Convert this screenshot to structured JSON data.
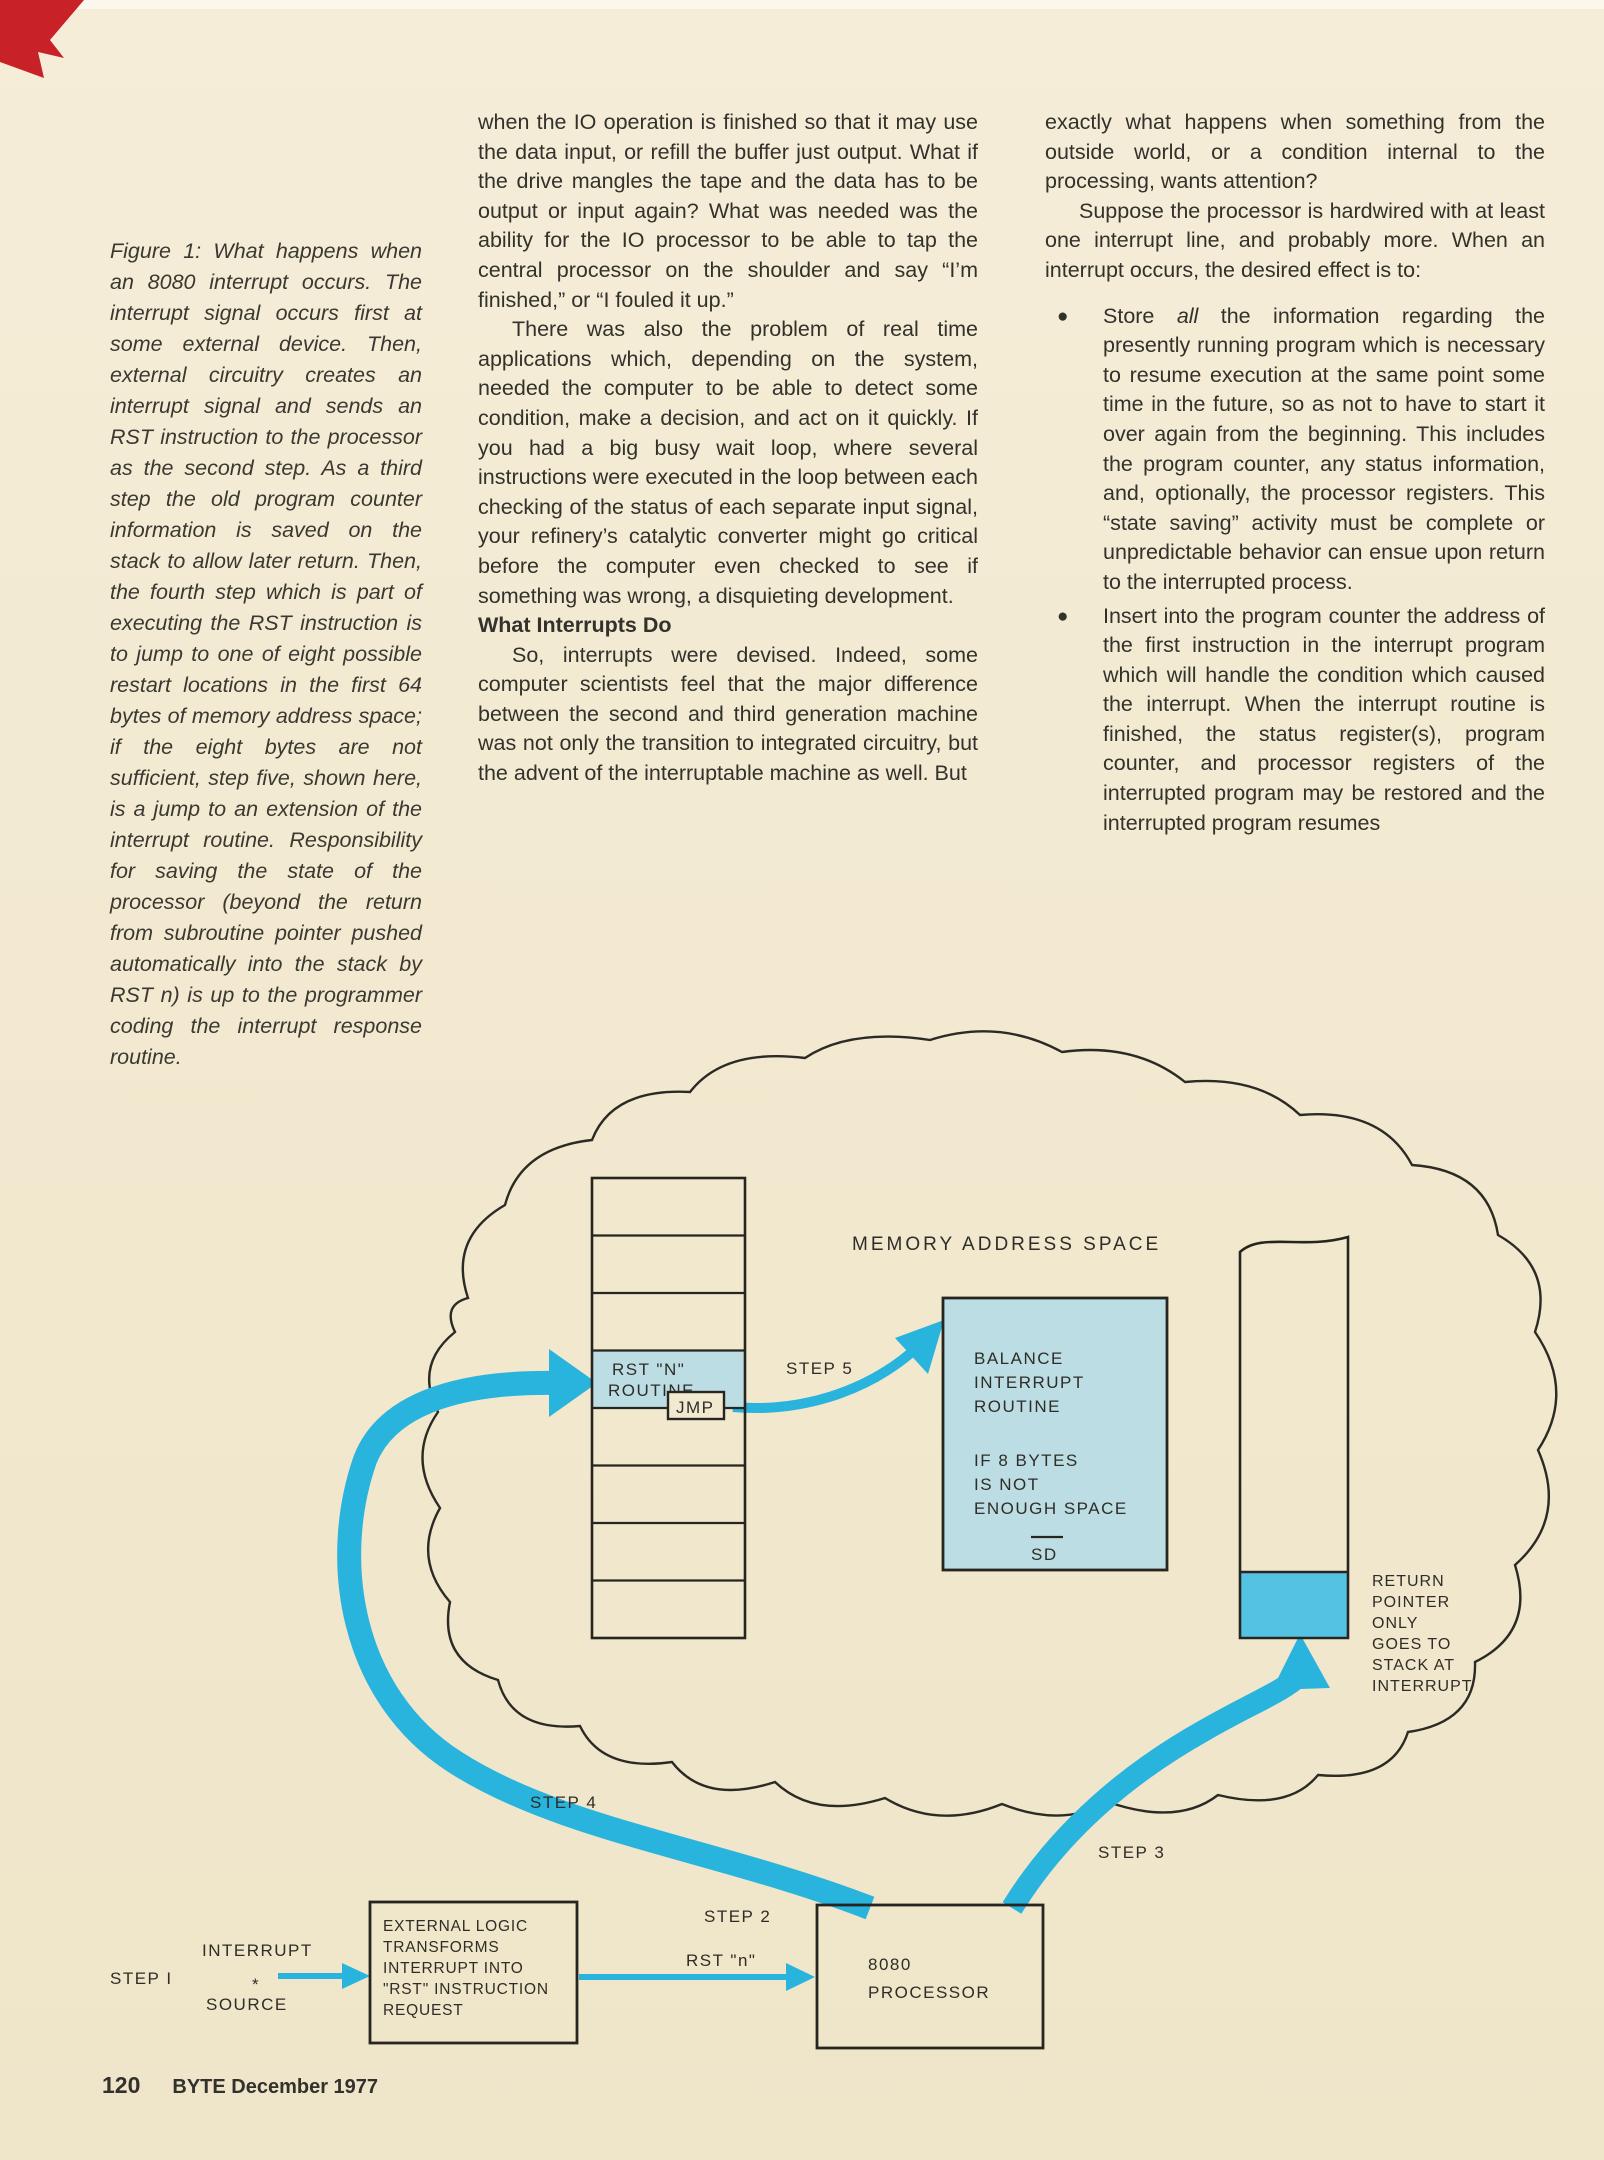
{
  "figure_caption": {
    "text": "Figure 1: What happens when an 8080 interrupt occurs. The interrupt signal occurs first at some external device. Then, external circuitry creates an interrupt signal and sends an RST instruction to the processor as the second step. As a third step the old program counter information is saved on the stack to allow later return. Then, the fourth step which is part of executing the RST instruction is to jump to one of eight possible restart locations in the first 64 bytes of memory address space; if the eight bytes are not sufficient, step five, shown here, is a jump to an extension of the interrupt routine. Responsibility for saving the state of the processor (beyond the return from subroutine pointer pushed automatically into the stack by RST n) is up to the programmer coding the interrupt response routine."
  },
  "middle_column": {
    "para1": "when the IO operation is finished so that it may use the data input, or refill the buffer just output. What if the drive mangles the tape and the data has to be output or input again? What was needed was the ability for the IO processor to be able to tap the central processor on the shoulder and say “I’m finished,” or “I fouled it up.”",
    "para2": "There was also the problem of real time applications which, depending on the system, needed the computer to be able to detect some condition, make a decision, and act on it quickly. If you had a big busy wait loop, where several instructions were executed in the loop between each checking of the status of each separate input signal, your refinery’s catalytic converter might go critical before the computer even checked to see if something was wrong, a disquieting development.",
    "heading": "What Interrupts Do",
    "para3": "So, interrupts were devised. Indeed, some computer scientists feel that the major difference between the second and third generation machine was not only the transition to integrated circuitry, but the advent of the interruptable machine as well. But"
  },
  "right_column": {
    "para1": "exactly what happens when something from the outside world, or a condition internal to the processing, wants attention?",
    "para2": "Suppose the processor is hardwired with at least one interrupt line, and probably more. When an interrupt occurs, the desired effect is to:",
    "bullet_marker": "●",
    "bullet1_pre": "Store ",
    "bullet1_italic": "all",
    "bullet1_post": " the information regarding the presently running program which is necessary to resume execution at the same point some time in the future, so as not to have to start it over again from the beginning. This includes the program counter, any status information, and, optionally, the processor registers. This “state saving” activity must be complete or unpredictable behavior can ensue upon return to the interrupted process.",
    "bullet2": "Insert into the program counter the address of the first instruction in the interrupt program which will handle the condition which caused the interrupt. When the interrupt routine is finished, the status register(s), program counter, and processor registers of the interrupted program may be restored and the interrupted program resumes"
  },
  "diagram": {
    "title": "MEMORY  ADDRESS  SPACE",
    "memory_column": {
      "rst_cell_line1": "RST \"N\"",
      "rst_cell_line2": "ROUTINE",
      "jmp_label": "JMP"
    },
    "balance_box": {
      "line1": "BALANCE",
      "line2": "INTERRUPT",
      "line3": "ROUTINE",
      "line4": "IF 8 BYTES",
      "line5": "IS NOT",
      "line6": "ENOUGH  SPACE",
      "sd_label": "SD"
    },
    "stack_label": {
      "line1": "RETURN",
      "line2": "POINTER",
      "line3": "ONLY",
      "line4": "GOES TO",
      "line5": "STACK  AT",
      "line6": "INTERRUPT"
    },
    "steps": {
      "step1": "STEP I",
      "step2": "STEP 2",
      "step3": "STEP 3",
      "step4": "STEP 4",
      "step5": "STEP 5"
    },
    "rst_n_label": "RST \"n\"",
    "source_label": {
      "line1": "INTERRUPT",
      "star": "*",
      "line2": "SOURCE"
    },
    "external_box": {
      "line1": "EXTERNAL LOGIC",
      "line2": "TRANSFORMS",
      "line3": "INTERRUPT  INTO",
      "line4": "\"RST\" INSTRUCTION",
      "line5": "REQUEST"
    },
    "processor_box": {
      "line1": "8080",
      "line2": "PROCESSOR"
    },
    "colors": {
      "arrow_cyan": "#29b4de",
      "pale_blue": "#bcdde4",
      "stack_fill": "#54c3e3",
      "paper": "#f2e9d1",
      "ink": "#232younger2",
      "red_mark": "#c92128"
    }
  },
  "footer": {
    "page_number": "120",
    "magazine": "BYTE December 1977"
  }
}
